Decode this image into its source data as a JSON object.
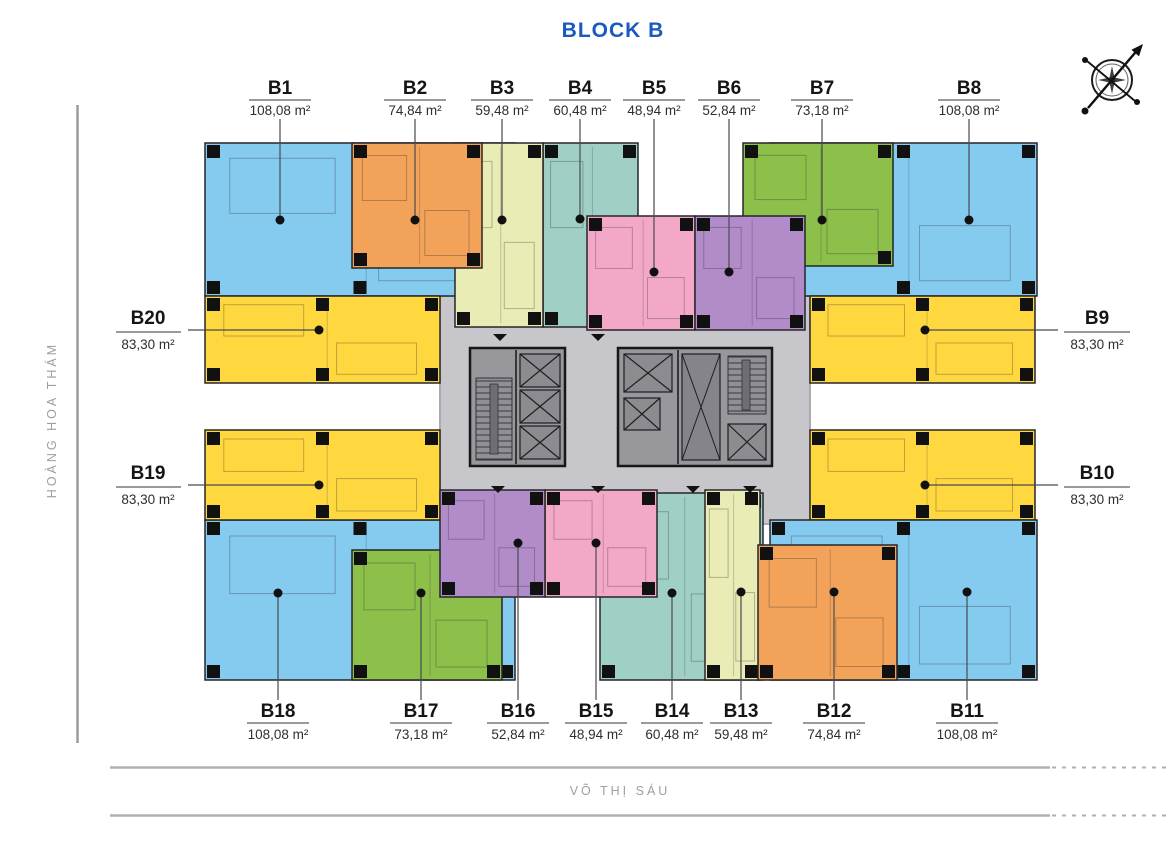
{
  "title": {
    "text": "BLOCK B",
    "color": "#1a5abf"
  },
  "streets": {
    "left": "HOÀNG HOA THÁM",
    "bottom": "VÕ THỊ SÁU"
  },
  "compass": {
    "icon": "compass-rose"
  },
  "palette": {
    "blue": "#85caef",
    "orange": "#f2a359",
    "cream": "#e9ecb4",
    "teal": "#9fcfc5",
    "pink": "#f4a8c8",
    "purple": "#b18cc9",
    "green": "#8dbf4b",
    "yellow": "#ffd840",
    "walkway_gray": "#c7c7cb",
    "core_gray": "#97979c"
  },
  "units": [
    {
      "id": "B1",
      "area": "108,08 m²",
      "color": "#85caef",
      "rect": [
        205,
        143,
        310,
        153
      ],
      "z": 1,
      "side": "top",
      "dot": [
        280,
        220
      ]
    },
    {
      "id": "B2",
      "area": "74,84 m²",
      "color": "#f2a359",
      "rect": [
        352,
        143,
        130,
        125
      ],
      "z": 4,
      "side": "top",
      "dot": [
        415,
        220
      ]
    },
    {
      "id": "B3",
      "area": "59,48 m²",
      "color": "#e9ecb4",
      "rect": [
        455,
        143,
        88,
        184
      ],
      "z": 3,
      "side": "top",
      "dot": [
        502,
        220
      ]
    },
    {
      "id": "B4",
      "area": "60,48 m²",
      "color": "#9fcfc5",
      "rect": [
        543,
        143,
        95,
        184
      ],
      "z": 2,
      "side": "top",
      "dot": [
        580,
        219
      ]
    },
    {
      "id": "B5",
      "area": "48,94 m²",
      "color": "#f4a8c8",
      "rect": [
        587,
        216,
        108,
        114
      ],
      "z": 3,
      "side": "top",
      "dot": [
        654,
        272
      ]
    },
    {
      "id": "B6",
      "area": "52,84 m²",
      "color": "#b18cc9",
      "rect": [
        695,
        216,
        110,
        114
      ],
      "z": 3,
      "side": "top",
      "dot": [
        729,
        272
      ]
    },
    {
      "id": "B7",
      "area": "73,18 m²",
      "color": "#8dbf4b",
      "rect": [
        743,
        143,
        150,
        123
      ],
      "z": 2,
      "side": "top",
      "dot": [
        822,
        220
      ]
    },
    {
      "id": "B8",
      "area": "108,08 m²",
      "color": "#85caef",
      "rect": [
        770,
        143,
        267,
        153
      ],
      "z": 1,
      "side": "top",
      "dot": [
        969,
        220
      ]
    },
    {
      "id": "B9",
      "area": "83,30 m²",
      "color": "#ffd840",
      "rect": [
        810,
        296,
        225,
        87
      ],
      "z": 1,
      "side": "right",
      "dot": [
        925,
        330
      ]
    },
    {
      "id": "B10",
      "area": "83,30 m²",
      "color": "#ffd840",
      "rect": [
        810,
        430,
        225,
        90
      ],
      "z": 1,
      "side": "right",
      "dot": [
        925,
        485
      ]
    },
    {
      "id": "B11",
      "area": "108,08 m²",
      "color": "#85caef",
      "rect": [
        770,
        520,
        267,
        160
      ],
      "z": 1,
      "side": "bottom",
      "dot": [
        967,
        592
      ]
    },
    {
      "id": "B12",
      "area": "74,84 m²",
      "color": "#f2a359",
      "rect": [
        758,
        545,
        139,
        135
      ],
      "z": 4,
      "side": "bottom",
      "dot": [
        834,
        592
      ]
    },
    {
      "id": "B13",
      "area": "59,48 m²",
      "color": "#e9ecb4",
      "rect": [
        705,
        490,
        55,
        190
      ],
      "z": 3,
      "side": "bottom",
      "dot": [
        741,
        592
      ]
    },
    {
      "id": "B14",
      "area": "60,48 m²",
      "color": "#9fcfc5",
      "rect": [
        600,
        493,
        163,
        187
      ],
      "z": 2,
      "side": "bottom",
      "dot": [
        672,
        593
      ]
    },
    {
      "id": "B15",
      "area": "48,94 m²",
      "color": "#f4a8c8",
      "rect": [
        545,
        490,
        112,
        107
      ],
      "z": 3,
      "side": "bottom",
      "dot": [
        596,
        543
      ]
    },
    {
      "id": "B16",
      "area": "52,84 m²",
      "color": "#b18cc9",
      "rect": [
        440,
        490,
        105,
        107
      ],
      "z": 3,
      "side": "bottom",
      "dot": [
        518,
        543
      ]
    },
    {
      "id": "B17",
      "area": "73,18 m²",
      "color": "#8dbf4b",
      "rect": [
        352,
        550,
        150,
        130
      ],
      "z": 2,
      "side": "bottom",
      "dot": [
        421,
        593
      ]
    },
    {
      "id": "B18",
      "area": "108,08 m²",
      "color": "#85caef",
      "rect": [
        205,
        520,
        310,
        160
      ],
      "z": 1,
      "side": "bottom",
      "dot": [
        278,
        593
      ]
    },
    {
      "id": "B19",
      "area": "83,30 m²",
      "color": "#ffd840",
      "rect": [
        205,
        430,
        235,
        90
      ],
      "z": 1,
      "side": "left",
      "dot": [
        319,
        485
      ]
    },
    {
      "id": "B20",
      "area": "83,30 m²",
      "color": "#ffd840",
      "rect": [
        205,
        296,
        235,
        87
      ],
      "z": 1,
      "side": "left",
      "dot": [
        319,
        330
      ]
    }
  ]
}
